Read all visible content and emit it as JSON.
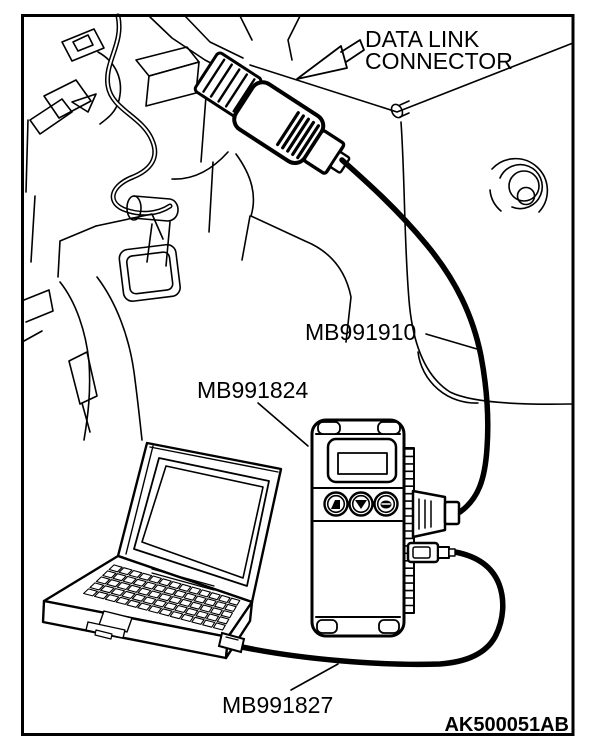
{
  "figure": {
    "labels": {
      "connector_line1": "DATA LINK",
      "connector_line2": "CONNECTOR",
      "cable_dlc": "MB991910",
      "interface_unit": "MB991824",
      "cable_pc": "MB991827"
    },
    "figure_code": "AK500051AB",
    "colors": {
      "line": "#000000",
      "background": "#ffffff"
    },
    "parts": [
      {
        "id": "MB991910",
        "role": "cable from data link connector to interface"
      },
      {
        "id": "MB991824",
        "role": "hand-held interface unit with display and three buttons"
      },
      {
        "id": "MB991827",
        "role": "cable from interface to laptop computer"
      }
    ]
  }
}
